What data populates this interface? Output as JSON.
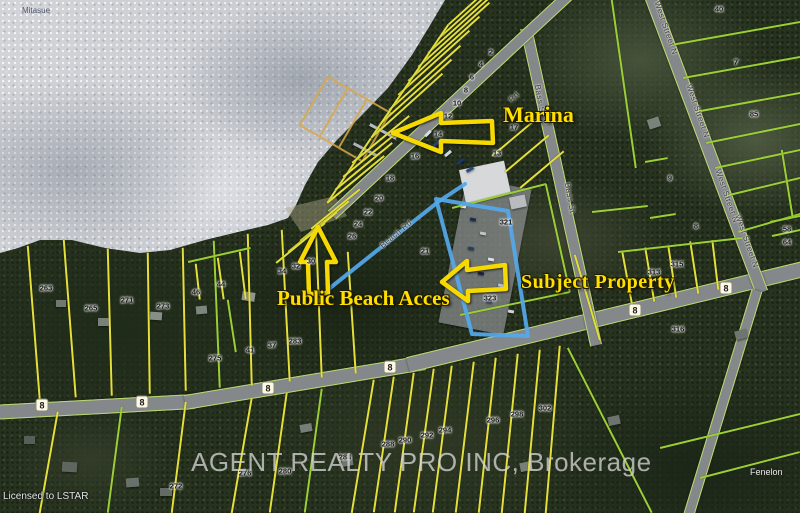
{
  "map": {
    "annotations": {
      "marina": "Marina",
      "public_beach": "Public Beach Acces",
      "subject_property": "Subject Property"
    },
    "watermark": "AGENT REALTY PRO INC, Brokerage",
    "license": "Licensed to LSTAR",
    "corner_labels": [
      {
        "text": "Mitasue",
        "x": 22,
        "y": 6,
        "kind": "lake"
      },
      {
        "text": "Fenelon",
        "x": 750,
        "y": 467,
        "kind": "place"
      }
    ],
    "street_labels": [
      {
        "text": "Bass St",
        "x": 540,
        "y": 100,
        "angle": 80
      },
      {
        "text": "Bass St",
        "x": 570,
        "y": 198,
        "angle": 80
      },
      {
        "text": "West Street N",
        "x": 666,
        "y": 28,
        "angle": 71
      },
      {
        "text": "West Street N",
        "x": 698,
        "y": 111,
        "angle": 71
      },
      {
        "text": "West Street N",
        "x": 727,
        "y": 196,
        "angle": 71
      },
      {
        "text": "West Street N",
        "x": 747,
        "y": 241,
        "angle": 71
      },
      {
        "text": "Rd",
        "x": 514,
        "y": 97,
        "angle": -43
      },
      {
        "text": "Beach Rd",
        "x": 396,
        "y": 234,
        "angle": -40
      }
    ],
    "road_shields": [
      {
        "label": "8",
        "x": 42,
        "y": 405
      },
      {
        "label": "8",
        "x": 142,
        "y": 402
      },
      {
        "label": "8",
        "x": 268,
        "y": 388
      },
      {
        "label": "8",
        "x": 390,
        "y": 367
      },
      {
        "label": "8",
        "x": 635,
        "y": 310
      },
      {
        "label": "8",
        "x": 726,
        "y": 288
      }
    ],
    "parcel_numbers": [
      {
        "n": "2",
        "x": 491,
        "y": 52
      },
      {
        "n": "4",
        "x": 481,
        "y": 64
      },
      {
        "n": "6",
        "x": 472,
        "y": 77
      },
      {
        "n": "8",
        "x": 466,
        "y": 90
      },
      {
        "n": "10",
        "x": 457,
        "y": 103
      },
      {
        "n": "12",
        "x": 448,
        "y": 116
      },
      {
        "n": "14",
        "x": 438,
        "y": 134
      },
      {
        "n": "16",
        "x": 415,
        "y": 156
      },
      {
        "n": "18",
        "x": 390,
        "y": 178
      },
      {
        "n": "20",
        "x": 379,
        "y": 198
      },
      {
        "n": "22",
        "x": 368,
        "y": 212
      },
      {
        "n": "24",
        "x": 358,
        "y": 224
      },
      {
        "n": "26",
        "x": 352,
        "y": 236
      },
      {
        "n": "30",
        "x": 311,
        "y": 261
      },
      {
        "n": "32",
        "x": 296,
        "y": 266
      },
      {
        "n": "34",
        "x": 282,
        "y": 271
      },
      {
        "n": "21",
        "x": 425,
        "y": 251
      },
      {
        "n": "13",
        "x": 497,
        "y": 153
      },
      {
        "n": "17",
        "x": 514,
        "y": 127
      },
      {
        "n": "321",
        "x": 506,
        "y": 222
      },
      {
        "n": "323",
        "x": 490,
        "y": 298
      },
      {
        "n": "263",
        "x": 46,
        "y": 288
      },
      {
        "n": "265",
        "x": 91,
        "y": 308
      },
      {
        "n": "271",
        "x": 127,
        "y": 300
      },
      {
        "n": "273",
        "x": 163,
        "y": 306
      },
      {
        "n": "46",
        "x": 196,
        "y": 292
      },
      {
        "n": "44",
        "x": 221,
        "y": 284
      },
      {
        "n": "275",
        "x": 215,
        "y": 358
      },
      {
        "n": "41",
        "x": 250,
        "y": 350
      },
      {
        "n": "37",
        "x": 272,
        "y": 345
      },
      {
        "n": "283",
        "x": 295,
        "y": 341
      },
      {
        "n": "272",
        "x": 176,
        "y": 486
      },
      {
        "n": "276",
        "x": 245,
        "y": 473
      },
      {
        "n": "280",
        "x": 285,
        "y": 471
      },
      {
        "n": "284",
        "x": 345,
        "y": 457
      },
      {
        "n": "288",
        "x": 388,
        "y": 444
      },
      {
        "n": "290",
        "x": 405,
        "y": 440
      },
      {
        "n": "292",
        "x": 427,
        "y": 435
      },
      {
        "n": "294",
        "x": 445,
        "y": 430
      },
      {
        "n": "296",
        "x": 493,
        "y": 420
      },
      {
        "n": "298",
        "x": 517,
        "y": 414
      },
      {
        "n": "302",
        "x": 545,
        "y": 408
      },
      {
        "n": "313",
        "x": 654,
        "y": 272
      },
      {
        "n": "315",
        "x": 677,
        "y": 264
      },
      {
        "n": "316",
        "x": 678,
        "y": 329
      },
      {
        "n": "40",
        "x": 719,
        "y": 9
      },
      {
        "n": "7",
        "x": 736,
        "y": 62
      },
      {
        "n": "85",
        "x": 754,
        "y": 114
      },
      {
        "n": "9",
        "x": 670,
        "y": 178
      },
      {
        "n": "8",
        "x": 696,
        "y": 226
      },
      {
        "n": "58",
        "x": 787,
        "y": 229
      },
      {
        "n": "64",
        "x": 787,
        "y": 242
      }
    ]
  }
}
